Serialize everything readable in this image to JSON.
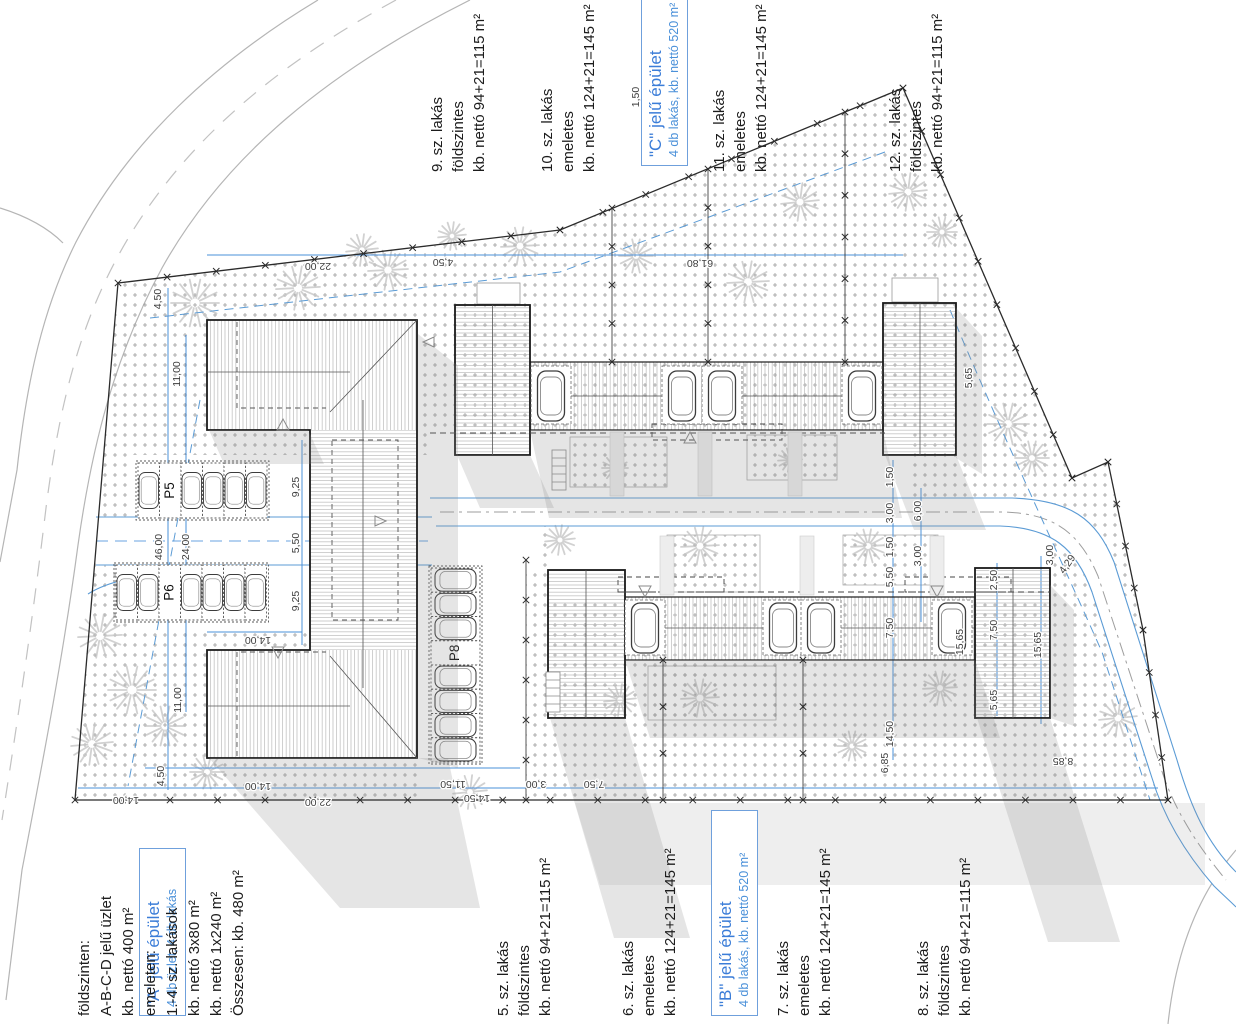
{
  "annotations": {
    "top": [
      {
        "id": "apt9",
        "lines": [
          "9. sz. lakás",
          "földszintes",
          "kb. nettó 94+21=115 m²"
        ]
      },
      {
        "id": "apt10",
        "lines": [
          "10. sz. lakás",
          "emeletes",
          "kb. nettó 124+21=145 m²"
        ]
      },
      {
        "id": "building-c",
        "title": "\"C\" jelű épület",
        "subtitle": "4 db lakás, kb. nettó 520 m²"
      },
      {
        "id": "apt11",
        "lines": [
          "11. sz. lakás",
          "emeletes",
          "kb. nettó 124+21=145 m²"
        ]
      },
      {
        "id": "apt12",
        "lines": [
          "12. sz. lakás",
          "földszintes",
          "kb. nettó 94+21=115 m²"
        ]
      }
    ],
    "bottom": [
      {
        "id": "building-a",
        "title": "\"A\" jelű épület",
        "subtitle": "4 db üzlet, 4 db lakás"
      },
      {
        "id": "building-a-details",
        "lines": [
          "földszinten:",
          "A-B-C-D jelű üzlet",
          "kb. nettó 400 m²",
          "emeleten:",
          "1.-4. sz. lakások",
          "kb. nettó 3x80 m²",
          "kb. nettó 1x240 m²",
          "Összesen: kb. 480 m²"
        ]
      },
      {
        "id": "apt5",
        "lines": [
          "5. sz. lakás",
          "földszintes",
          "kb. nettó 94+21=115 m²"
        ]
      },
      {
        "id": "apt6",
        "lines": [
          "6. sz. lakás",
          "emeletes",
          "kb. nettó 124+21=145 m²"
        ]
      },
      {
        "id": "building-b",
        "title": "\"B\" jelű épület",
        "subtitle": "4 db lakás, kb. nettó 520 m²"
      },
      {
        "id": "apt7",
        "lines": [
          "7. sz. lakás",
          "emeletes",
          "kb. nettó 124+21=145 m²"
        ]
      },
      {
        "id": "apt8",
        "lines": [
          "8. sz. lakás",
          "földszintes",
          "kb. nettó 94+21=115 m²"
        ]
      }
    ]
  },
  "parking_labels": {
    "p5": "P5",
    "p6": "P6",
    "p8": "P8"
  },
  "colors": {
    "dimension_blue": "#4a90d9",
    "road_blue": "#5b9bd5",
    "label_blue": "#3b7dd8",
    "boundary": "#2b2b2b",
    "shadow": "#8a8a8a"
  },
  "dimensions": [
    {
      "t": "22,00",
      "x": 318,
      "y": 263,
      "r": 180
    },
    {
      "t": "4,50",
      "x": 443,
      "y": 259,
      "r": 180
    },
    {
      "t": "61,80",
      "x": 700,
      "y": 260,
      "r": 180
    },
    {
      "t": "4,50",
      "x": 161,
      "y": 299,
      "r": -90
    },
    {
      "t": "11,00",
      "x": 180,
      "y": 374,
      "r": -90
    },
    {
      "t": "46,00",
      "x": 162,
      "y": 547,
      "r": -90
    },
    {
      "t": "24,00",
      "x": 189,
      "y": 547,
      "r": -90
    },
    {
      "t": "11,00",
      "x": 181,
      "y": 700,
      "r": -90
    },
    {
      "t": "4,50",
      "x": 164,
      "y": 776,
      "r": -90
    },
    {
      "t": "9,25",
      "x": 299,
      "y": 487,
      "r": -90
    },
    {
      "t": "5,50",
      "x": 299,
      "y": 543,
      "r": -90
    },
    {
      "t": "9,25",
      "x": 299,
      "y": 601,
      "r": -90
    },
    {
      "t": "14,00",
      "x": 258,
      "y": 637,
      "r": 180
    },
    {
      "t": "14,00",
      "x": 258,
      "y": 783,
      "r": 180
    },
    {
      "t": "11,50",
      "x": 453,
      "y": 781,
      "r": 180
    },
    {
      "t": "14,00",
      "x": 126,
      "y": 797,
      "r": 180
    },
    {
      "t": "22,00",
      "x": 318,
      "y": 799,
      "r": 180
    },
    {
      "t": "14,50",
      "x": 477,
      "y": 795,
      "r": 180
    },
    {
      "t": "3,00",
      "x": 536,
      "y": 781,
      "r": 180
    },
    {
      "t": "7,50",
      "x": 594,
      "y": 781,
      "r": 180
    },
    {
      "t": "1,50",
      "x": 893,
      "y": 477,
      "r": -90
    },
    {
      "t": "3,00",
      "x": 893,
      "y": 513,
      "r": -90
    },
    {
      "t": "6,00",
      "x": 921,
      "y": 511,
      "r": -90
    },
    {
      "t": "1,50",
      "x": 893,
      "y": 547,
      "r": -90
    },
    {
      "t": "3,00",
      "x": 921,
      "y": 556,
      "r": -90
    },
    {
      "t": "5,50",
      "x": 893,
      "y": 577,
      "r": -90
    },
    {
      "t": "7,50",
      "x": 893,
      "y": 628,
      "r": -90
    },
    {
      "t": "14,50",
      "x": 893,
      "y": 734,
      "r": -90
    },
    {
      "t": "6,85",
      "x": 888,
      "y": 763,
      "r": -90
    },
    {
      "t": "5,65",
      "x": 972,
      "y": 378,
      "r": -90
    },
    {
      "t": "2,50",
      "x": 997,
      "y": 580,
      "r": -90
    },
    {
      "t": "7,50",
      "x": 997,
      "y": 630,
      "r": -90
    },
    {
      "t": "5,65",
      "x": 997,
      "y": 700,
      "r": -90
    },
    {
      "t": "15,65",
      "x": 963,
      "y": 642,
      "r": -90
    },
    {
      "t": "15,65",
      "x": 1041,
      "y": 645,
      "r": -90
    },
    {
      "t": "3,00",
      "x": 1053,
      "y": 555,
      "r": -90
    },
    {
      "t": "4,29",
      "x": 1070,
      "y": 566,
      "r": -55
    },
    {
      "t": "8,85",
      "x": 1063,
      "y": 758,
      "r": 180
    },
    {
      "t": "1,50",
      "x": 639,
      "y": 97,
      "r": -90
    }
  ],
  "trees": [
    [
      195,
      303,
      24
    ],
    [
      298,
      288,
      22
    ],
    [
      388,
      270,
      20
    ],
    [
      520,
      246,
      19
    ],
    [
      636,
      256,
      17
    ],
    [
      748,
      282,
      21
    ],
    [
      800,
      202,
      19
    ],
    [
      908,
      192,
      19
    ],
    [
      942,
      232,
      15
    ],
    [
      1008,
      424,
      21
    ],
    [
      1032,
      458,
      17
    ],
    [
      100,
      636,
      22
    ],
    [
      132,
      690,
      24
    ],
    [
      92,
      744,
      21
    ],
    [
      165,
      726,
      20
    ],
    [
      207,
      772,
      17
    ],
    [
      615,
      468,
      13
    ],
    [
      790,
      460,
      12
    ],
    [
      560,
      540,
      15
    ],
    [
      700,
      546,
      19
    ],
    [
      868,
      546,
      17
    ],
    [
      620,
      700,
      16
    ],
    [
      700,
      698,
      19
    ],
    [
      940,
      688,
      17
    ],
    [
      470,
      792,
      17
    ],
    [
      852,
      746,
      15
    ],
    [
      1118,
      718,
      19
    ],
    [
      362,
      250,
      16
    ],
    [
      452,
      236,
      14
    ]
  ],
  "boundary": {
    "points": [
      [
        118,
        283
      ],
      [
        560,
        230
      ],
      [
        903,
        88
      ],
      [
        1072,
        478
      ],
      [
        1108,
        462
      ],
      [
        1143,
        630
      ],
      [
        1168,
        800
      ],
      [
        75,
        800
      ]
    ],
    "xmark": [
      true,
      true,
      true,
      true,
      true,
      true,
      true,
      false
    ],
    "dividers": [
      [
        612,
        208,
        362
      ],
      [
        708,
        169,
        362
      ],
      [
        845,
        112,
        362
      ],
      [
        663,
        660,
        800
      ],
      [
        803,
        660,
        800
      ],
      [
        526,
        560,
        800
      ]
    ]
  }
}
